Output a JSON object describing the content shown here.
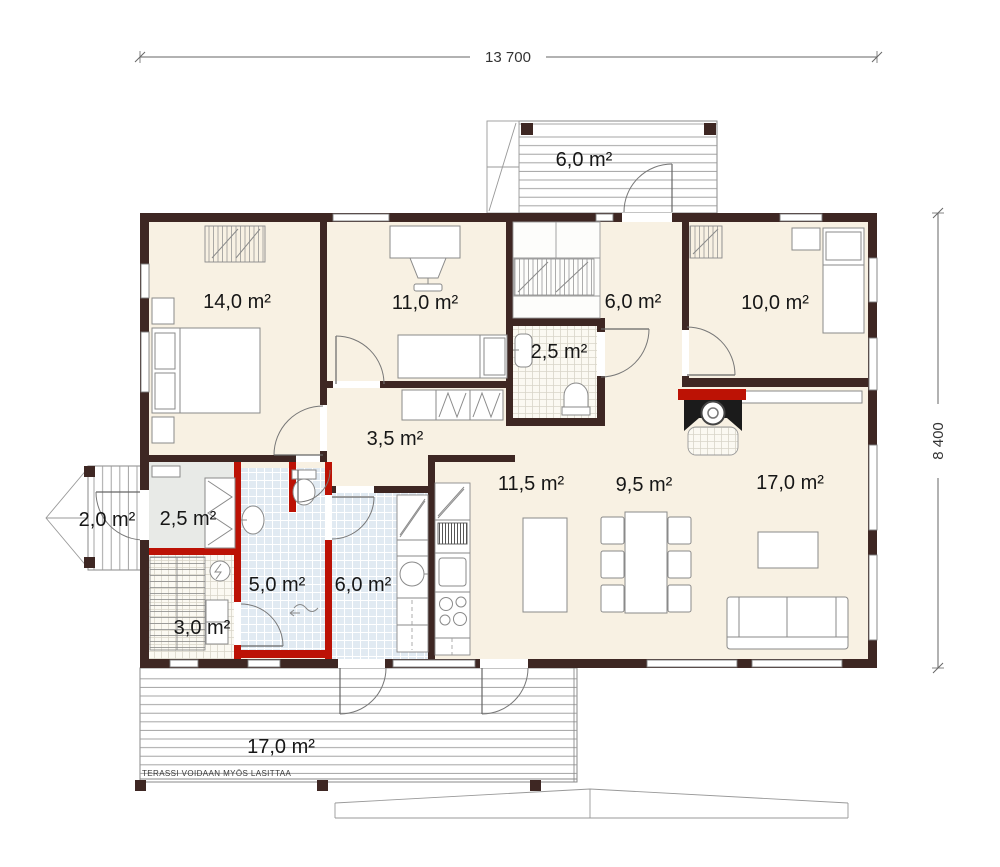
{
  "document": {
    "type": "floor-plan"
  },
  "dimensions": {
    "width": "13 700",
    "height": "8 400"
  },
  "rooms": [
    {
      "name": "entrance-porch",
      "area": "6,0 m²"
    },
    {
      "name": "bedroom-master",
      "area": "14,0 m²"
    },
    {
      "name": "bedroom-office",
      "area": "11,0 m²"
    },
    {
      "name": "entry-hall",
      "area": "6,0 m²"
    },
    {
      "name": "bedroom-right",
      "area": "10,0 m²"
    },
    {
      "name": "wc",
      "area": "2,5 m²"
    },
    {
      "name": "hallway",
      "area": "3,5 m²"
    },
    {
      "name": "kitchen",
      "area": "11,5 m²"
    },
    {
      "name": "dining",
      "area": "9,5 m²"
    },
    {
      "name": "living-room",
      "area": "17,0 m²"
    },
    {
      "name": "side-porch",
      "area": "2,0 m²"
    },
    {
      "name": "utility",
      "area": "2,5 m²"
    },
    {
      "name": "washroom",
      "area": "5,0 m²"
    },
    {
      "name": "utility-room",
      "area": "6,0 m²"
    },
    {
      "name": "sauna",
      "area": "3,0 m²"
    },
    {
      "name": "terrace",
      "area": "17,0 m²"
    }
  ],
  "annotations": {
    "terrace_note": "TERASSI VOIDAAN MYÖS LASITTAA"
  },
  "colors": {
    "wall": "#3E2723",
    "wet_wall": "#BC1205",
    "floor": "#F8F1E3",
    "tile": "#E1EAF2",
    "background": "#FFFFFF"
  }
}
